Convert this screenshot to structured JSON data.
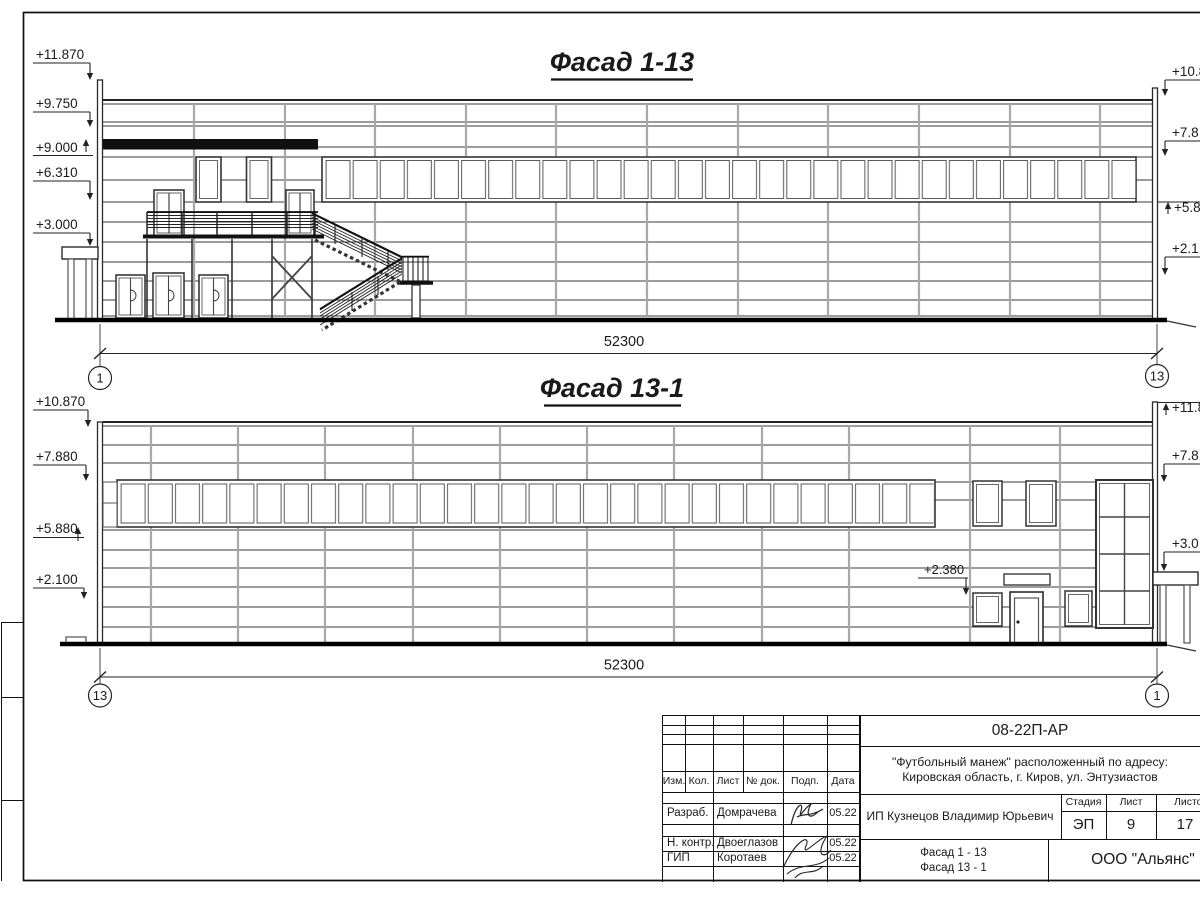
{
  "drawing": {
    "facade_top": {
      "title": "Фасад 1-13",
      "left_marks": [
        "+11.870",
        "+9.750",
        "+9.000",
        "+6.310",
        "+3.000"
      ],
      "right_marks": [
        "+10.8",
        "+7.8",
        "+5.8",
        "+2.1"
      ],
      "dimension": "52300",
      "grid_left": "1",
      "grid_right": "13"
    },
    "facade_bottom": {
      "title": "Фасад 13-1",
      "left_marks": [
        "+10.870",
        "+7.880",
        "+5.880",
        "+2.100"
      ],
      "right_marks": [
        "+11.8",
        "+7.8",
        "+3.0"
      ],
      "annotation": "+2.380",
      "dimension": "52300",
      "grid_left": "13",
      "grid_right": "1"
    }
  },
  "titleblock": {
    "doc_number": "08-22П-АР",
    "project_line1": "\"Футбольный манеж\" расположенный по адресу:",
    "project_line2": "Кировская область, г. Киров, ул. Энтузиастов",
    "client": "ИП Кузнецов Владимир Юрьевич",
    "stage_label": "Стадия",
    "sheet_label": "Лист",
    "sheets_label": "Листов",
    "stage": "ЭП",
    "sheet_number": "9",
    "sheets_total": "17",
    "content_line1": "Фасад 1 - 13",
    "content_line2": "Фасад 13 - 1",
    "organization": "ООО \"Альянс\"",
    "columns": {
      "izm": "Изм.",
      "kol": "Кол.",
      "list": "Лист",
      "doc": "№ док.",
      "podp": "Подп.",
      "data": "Дата"
    },
    "roles": {
      "developer": "Разраб.",
      "checker": "Н. контр.",
      "gip": "ГИП"
    },
    "names": {
      "developer": "Домрачева",
      "checker": "Двоеглазов",
      "gip": "Коротаев"
    },
    "dates": {
      "developer": "05.22",
      "checker": "05.22",
      "gip": "05.22"
    }
  }
}
